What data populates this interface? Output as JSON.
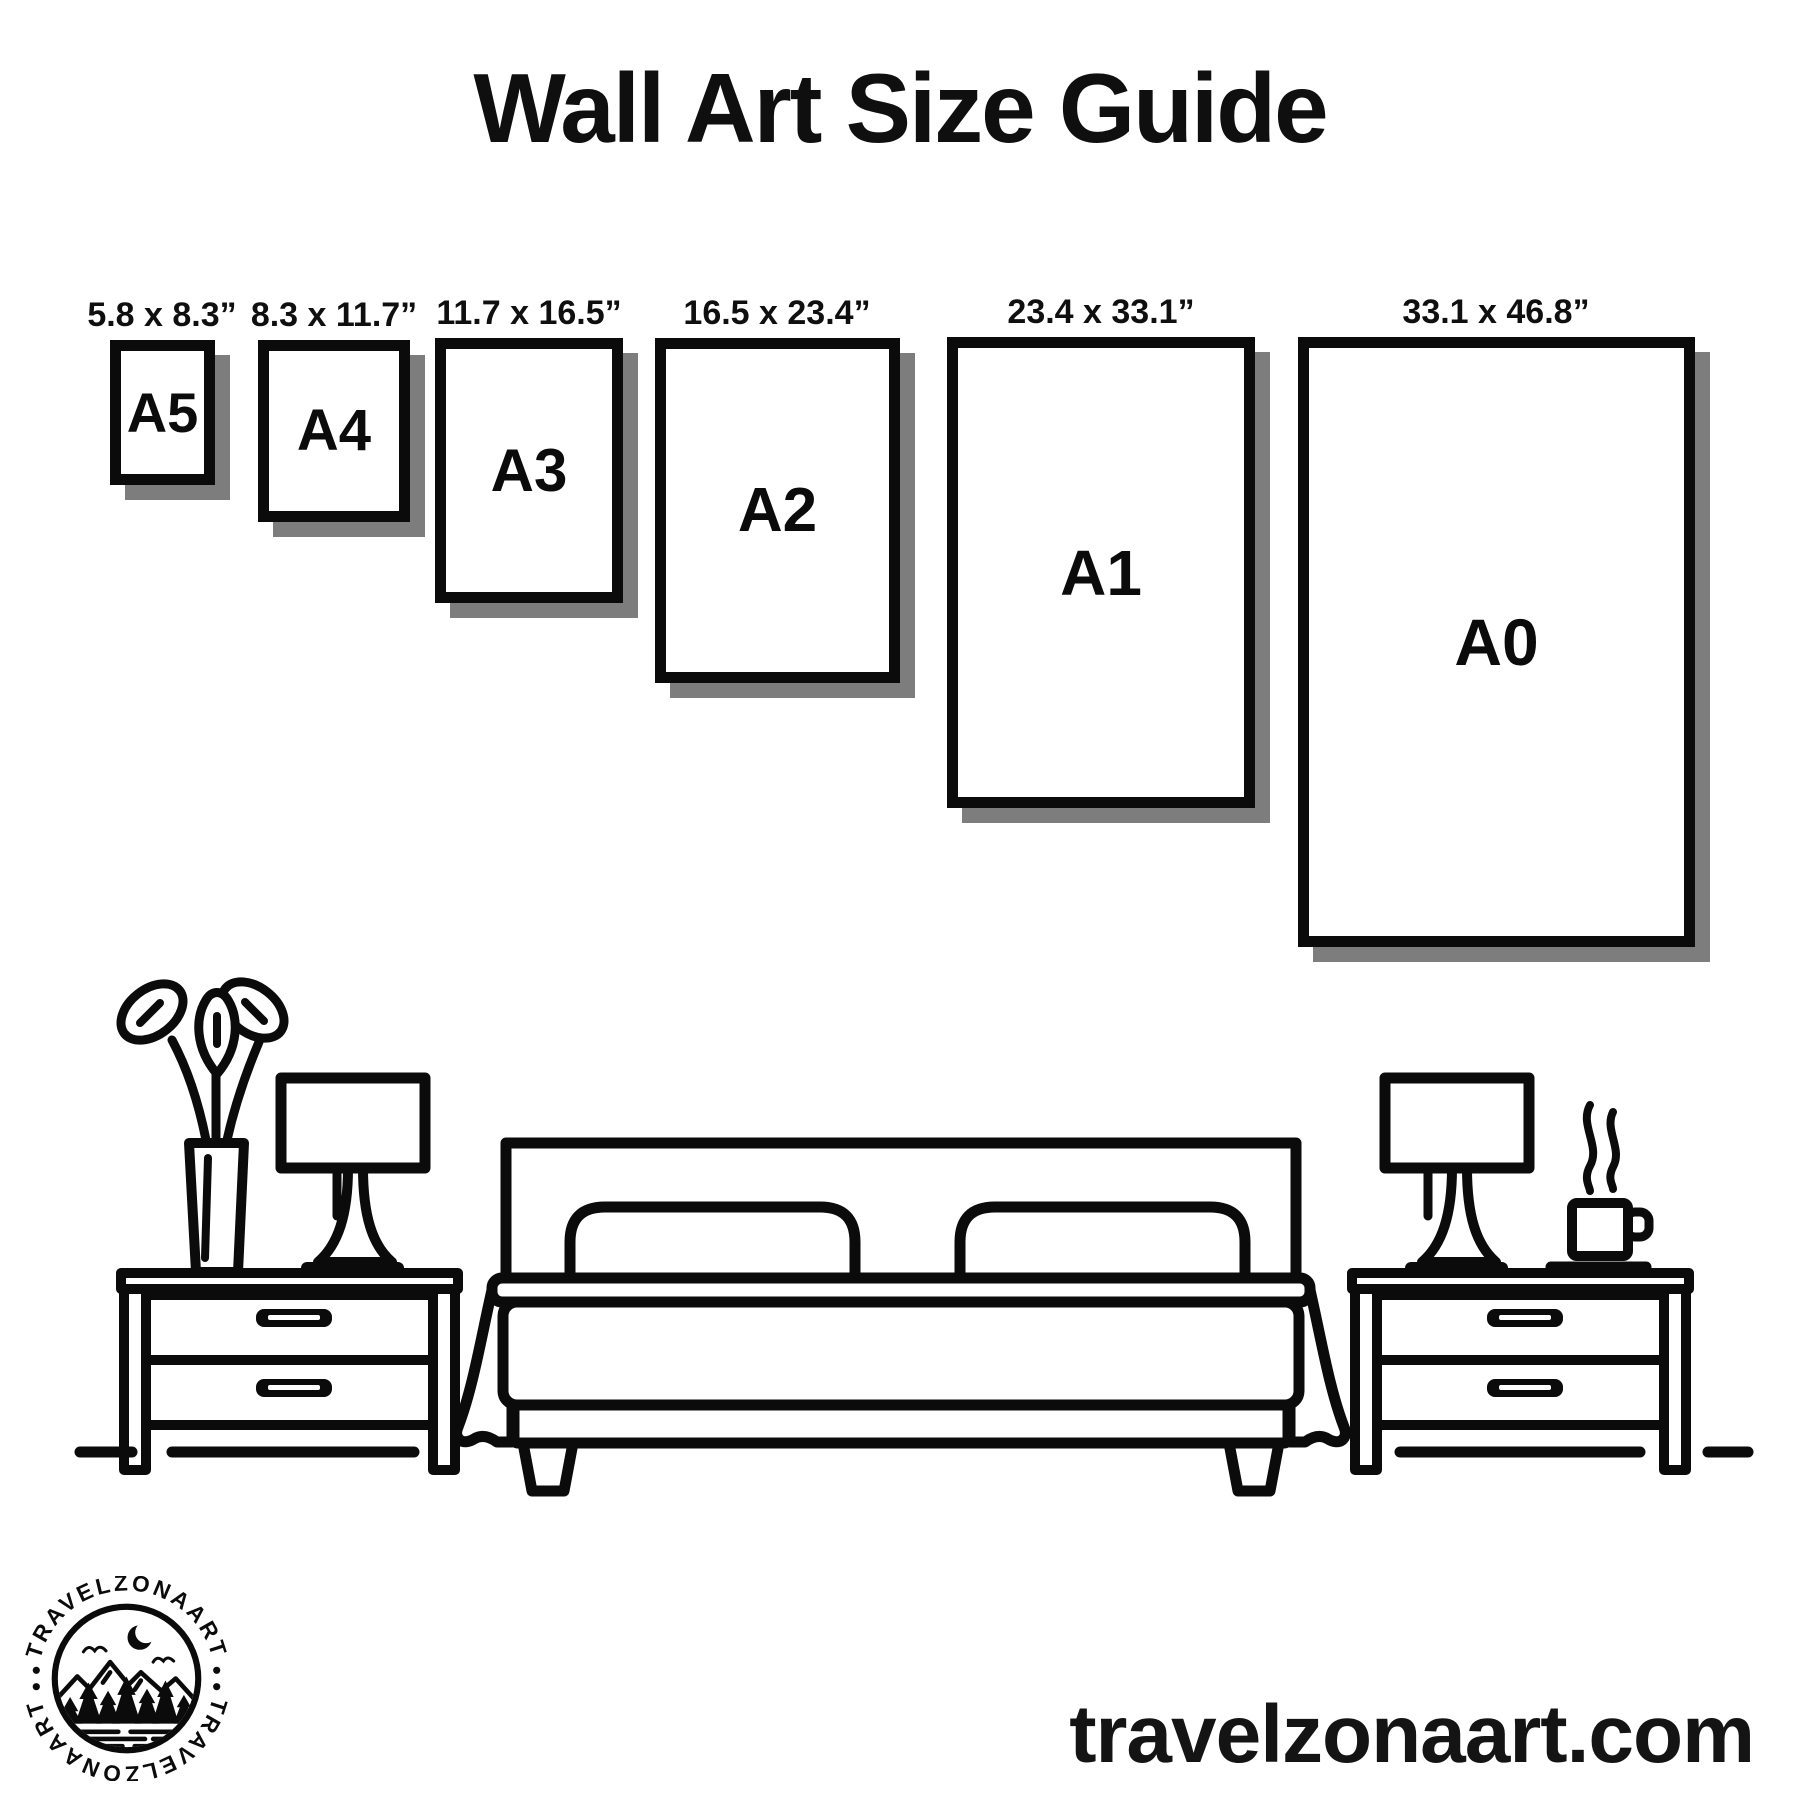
{
  "title": "Wall Art Size Guide",
  "papers": [
    {
      "name": "A5",
      "size_label": "5.8 x 8.3”"
    },
    {
      "name": "A4",
      "size_label": "8.3 x 11.7”"
    },
    {
      "name": "A3",
      "size_label": "11.7 x 16.5”"
    },
    {
      "name": "A2",
      "size_label": "16.5 x 23.4”"
    },
    {
      "name": "A1",
      "size_label": "23.4 x 33.1”"
    },
    {
      "name": "A0",
      "size_label": "33.1 x 46.8”"
    }
  ],
  "footer": {
    "website": "travelzonaart.com",
    "logo_text": "TRAVELZONAART"
  },
  "colors": {
    "ink": "#0b0b0b",
    "shadow": "#7d7d7d",
    "background": "#ffffff"
  }
}
